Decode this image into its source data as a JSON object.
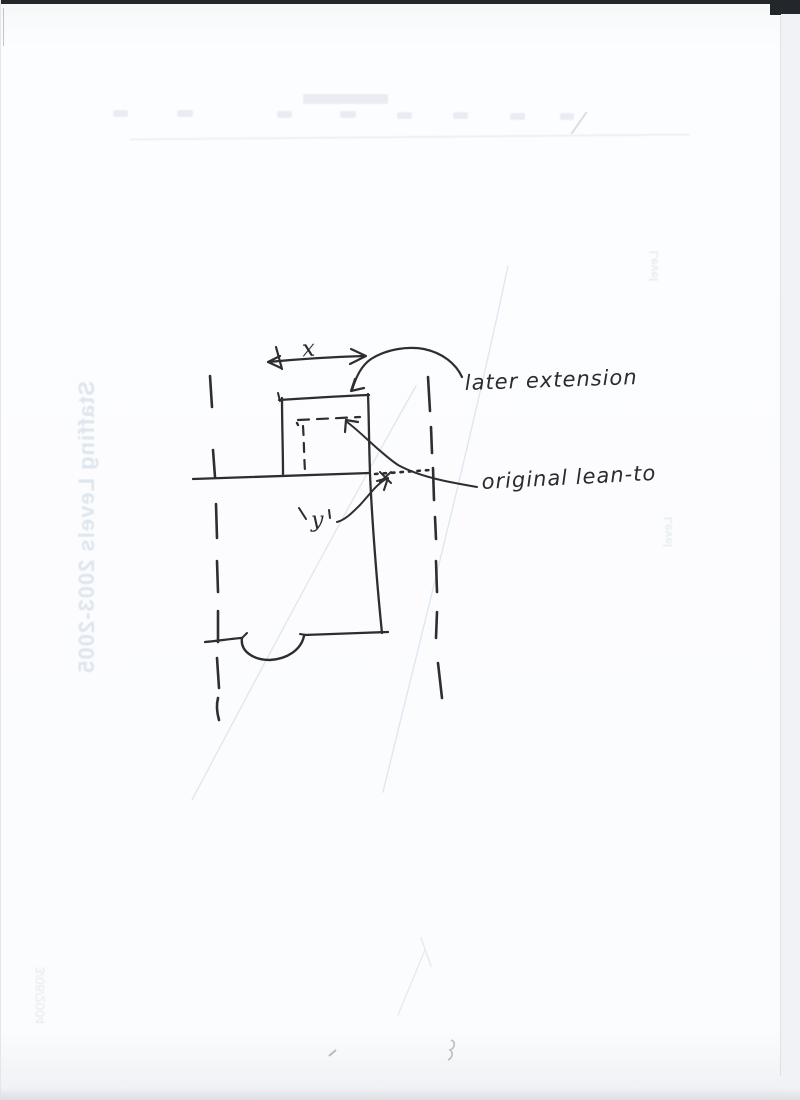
{
  "page": {
    "paper_color": "#fbfcfd",
    "ink_color": "#2e2e30",
    "bleed_text_color": "#dde5ee",
    "scan_edge_color": "#23272b"
  },
  "sketch": {
    "dimension_label": "x",
    "y_label": "y",
    "later_extension_label": "later extension",
    "original_lean_to_label": "original lean-to"
  },
  "bleed_through": {
    "side_title": "Staffing Levels 2003-2005",
    "footer_note": "3/08/2004",
    "right_snippet_top": "Level",
    "right_snippet_bottom": "Level"
  }
}
